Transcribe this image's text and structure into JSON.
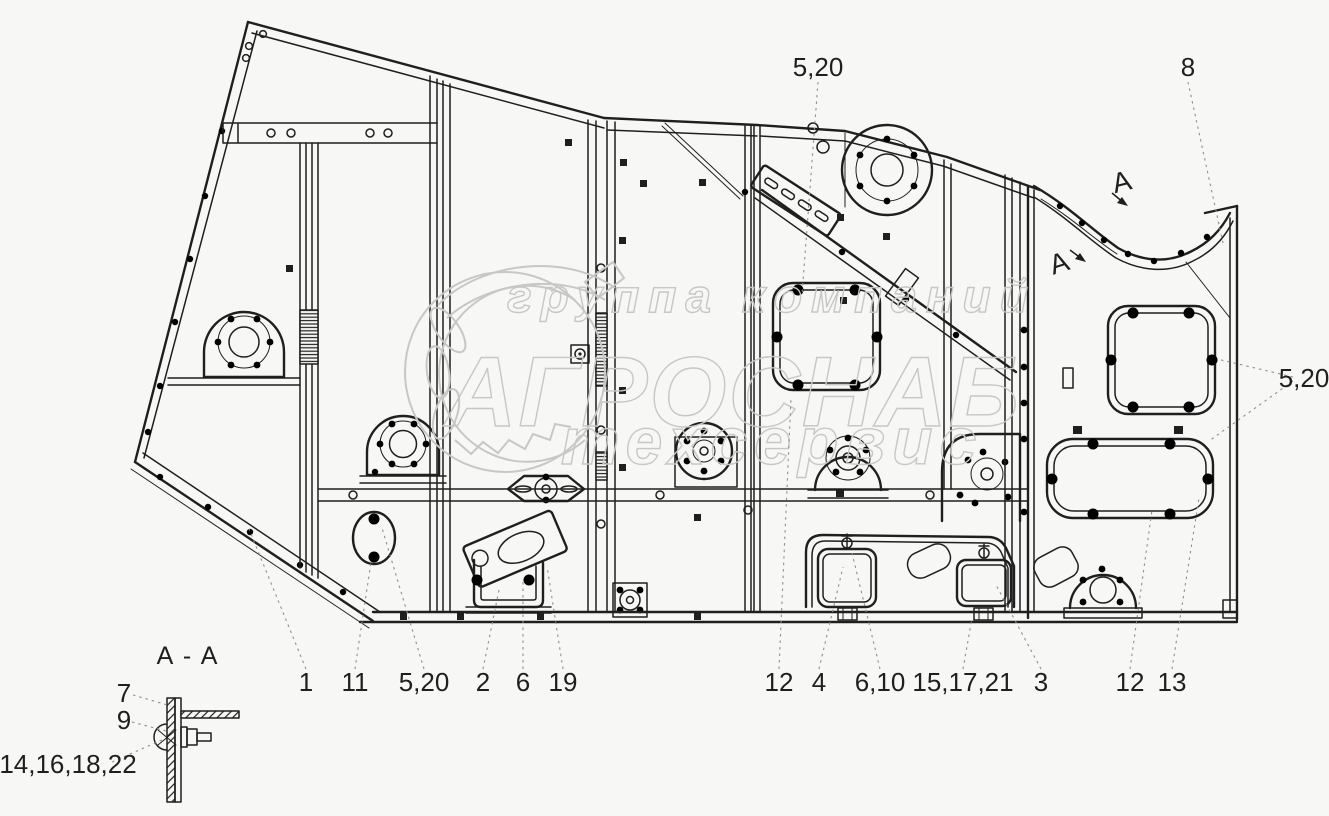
{
  "colors": {
    "line": "#1f1f1f",
    "leader": "#8f8f8f",
    "wm": "#c7c7c7",
    "background": "#f7f7f5"
  },
  "watermark": {
    "top": "группа компаний",
    "brand": "АГРОСНАБ",
    "bottom": "техсервис"
  },
  "cut_marks": {
    "upper": "A",
    "lower": "A"
  },
  "section_detail": {
    "title": "A - A",
    "labels": {
      "pin": "7",
      "washer": "9",
      "fasteners": "14,16,18,22"
    }
  },
  "callouts": {
    "top_hatch_bolts": "5,20",
    "top_curved_rail": "8",
    "right_hatch_bolts": "5,20",
    "bottom_row_left": [
      {
        "ref": "side-panel",
        "text": "1"
      },
      {
        "ref": "oval-cover",
        "text": "11"
      },
      {
        "ref": "oval-cover-bolts",
        "text": "5,20"
      },
      {
        "ref": "channel-bracket",
        "text": "2"
      },
      {
        "ref": "bracket-plate",
        "text": "6"
      },
      {
        "ref": "bracket-bolts",
        "text": "19"
      }
    ],
    "bottom_row_right": [
      {
        "ref": "mid-panel",
        "text": "12"
      },
      {
        "ref": "left-door",
        "text": "4"
      },
      {
        "ref": "left-door-bolts",
        "text": "6,10"
      },
      {
        "ref": "door-feet",
        "text": "15,17,21"
      },
      {
        "ref": "right-door",
        "text": "3"
      },
      {
        "ref": "lower-hatch",
        "text": "12"
      },
      {
        "ref": "lower-hatch-frame",
        "text": "13"
      }
    ]
  }
}
